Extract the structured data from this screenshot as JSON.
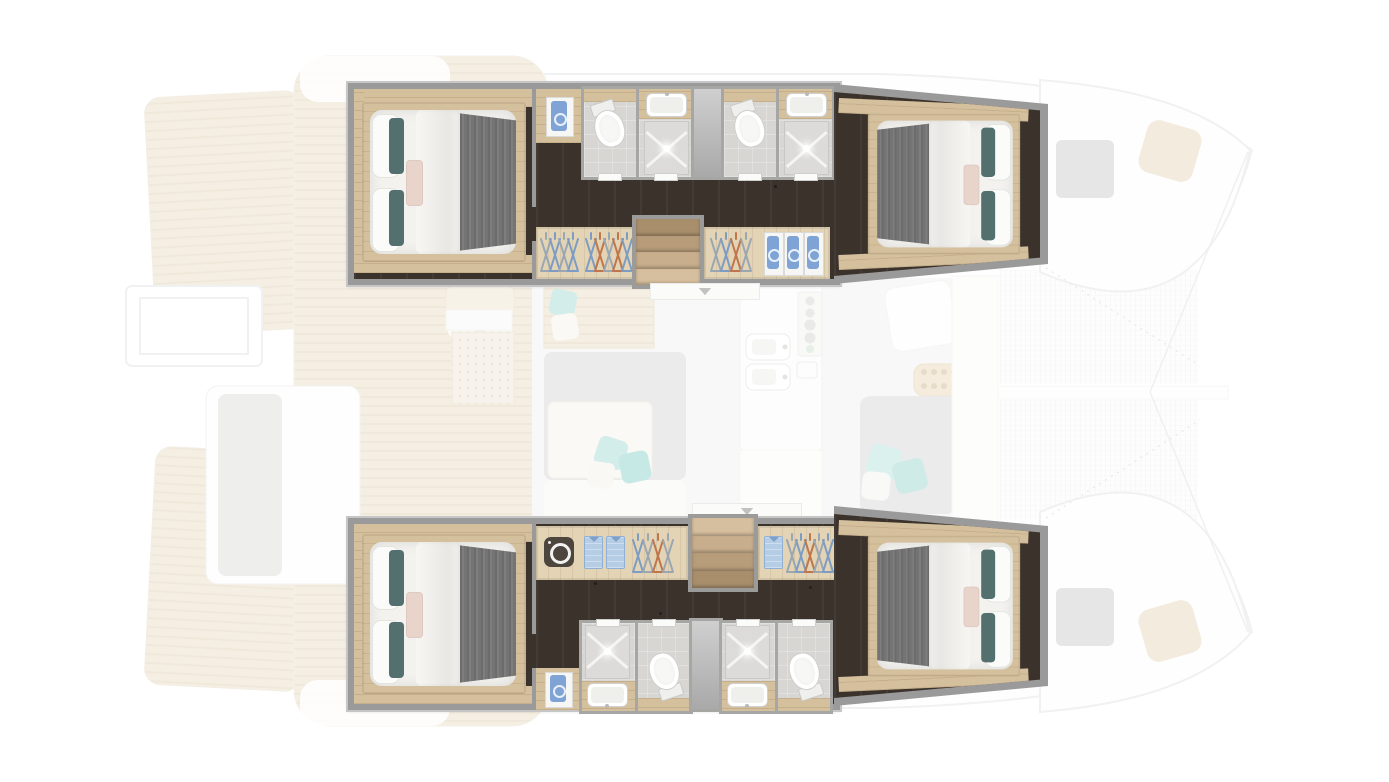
{
  "meta": {
    "description": "Top-down floor plan of a four-cabin catamaran yacht, bow to the right: two highlighted hull interiors each with two double cabins and two bathrooms, a faded central salon with galley, aft cockpit with teak deck and twin swim platforms, and twin bow trampolines."
  },
  "colors": {
    "hull_wall": "#9a9a9a",
    "hull_wall_light": "#c6c6c6",
    "floor_dark": "#3b322c",
    "wood": "#d5c09d",
    "wood_light": "#e3d4b6",
    "bath_floor": "#d8d6d3",
    "bath_wall": "#a6a6a4",
    "fixture": "#f7f7f5",
    "fixture_line": "#cfcfcd",
    "duvet": "#f3f2ef",
    "blanket": "#747474",
    "pillow_teal": "#53706e",
    "pillow_blush": "#e8d4cb",
    "aqua": "#a5dad4",
    "towel": "#7fa3d4",
    "shirt": "#b6cde6",
    "hanger_blue": "#7d9cc4",
    "hanger_gray": "#9aa6b2",
    "hanger_orange": "#c0754a",
    "washer": "#4d463e",
    "teak": "#eadfc7",
    "teak_stripe": "#e0d2b6",
    "salon_gray": "#d7d7d6",
    "outline": "#e0e3e7",
    "hatch": "#cdcdcd",
    "net": "#e7e7ea"
  },
  "boat": {
    "view": "top-down",
    "orientation": {
      "bow": "right",
      "stern": "left"
    },
    "counts": {
      "cabins": 4,
      "bathrooms": 4,
      "toilets": 4,
      "washbasins": 4,
      "showers": 4,
      "trampolines": 2,
      "swim_platforms": 2
    },
    "hulls": [
      {
        "id": "top-hull",
        "rooms": [
          {
            "name": "aft-cabin",
            "furniture": [
              "double-island-bed",
              "white-duvet",
              "gray-throw-blanket",
              "two-teal-lumbar-pillows",
              "blush-pillow",
              "oak-bed-platform"
            ]
          },
          {
            "name": "linen-cabinet",
            "contents": [
              "folded-blue-towel"
            ]
          },
          {
            "name": "aft-bathroom",
            "fixtures": [
              "toilet",
              "washbasin",
              "shower-with-x-tray"
            ]
          },
          {
            "name": "forward-bathroom",
            "fixtures": [
              "toilet",
              "washbasin",
              "shower-with-x-tray"
            ]
          },
          {
            "name": "wardrobe-aft",
            "contents": [
              "clothes-hangers"
            ],
            "hanger_count": 9
          },
          {
            "name": "companionway-stairs",
            "steps": 4
          },
          {
            "name": "wardrobe-forward",
            "contents": [
              "clothes-hangers",
              "three-blue-towels-on-shelf"
            ],
            "hanger_count": 4
          },
          {
            "name": "forward-cabin",
            "furniture": [
              "double-island-bed",
              "white-duvet",
              "gray-throw-blanket",
              "two-teal-lumbar-pillows",
              "striped-blush-pillow"
            ]
          }
        ]
      },
      {
        "id": "bottom-hull",
        "rooms": [
          {
            "name": "aft-cabin",
            "furniture": [
              "double-island-bed",
              "white-duvet",
              "gray-throw-blanket",
              "two-teal-lumbar-pillows",
              "blush-pillow",
              "oak-bed-platform"
            ]
          },
          {
            "name": "wardrobe-aft",
            "contents": [
              "washing-machine",
              "two-folded-blue-shirts",
              "clothes-hangers"
            ],
            "hanger_count": 4
          },
          {
            "name": "companionway-stairs",
            "steps": 4
          },
          {
            "name": "wardrobe-forward",
            "contents": [
              "folded-blue-shirt",
              "clothes-hangers"
            ],
            "hanger_count": 5
          },
          {
            "name": "linen-cabinet",
            "contents": [
              "folded-blue-towel"
            ]
          },
          {
            "name": "aft-bathroom",
            "fixtures": [
              "shower-with-x-tray",
              "washbasin",
              "toilet"
            ]
          },
          {
            "name": "forward-bathroom",
            "fixtures": [
              "shower-with-x-tray",
              "washbasin",
              "toilet"
            ]
          },
          {
            "name": "forward-cabin",
            "furniture": [
              "double-island-bed",
              "white-duvet",
              "gray-throw-blanket",
              "two-teal-lumbar-pillows",
              "striped-blush-pillow"
            ]
          }
        ]
      }
    ],
    "salon_faded": {
      "features": [
        "nav-station-with-perforated-panel",
        "sideboard",
        "l-shaped-settee",
        "cream-dining-table",
        "aqua-throw-pillows",
        "galley-double-sink",
        "burner-stove-panel",
        "counter-vents",
        "forward-seat",
        "cup-holder-tray",
        "sun-lounge"
      ]
    },
    "aft_deck_faded": {
      "features": [
        "teak-cockpit-deck",
        "cockpit-table-with-seats",
        "side-bench-with-gray-pad",
        "twin-teak-swim-platforms",
        "boarding-frame"
      ]
    },
    "bow_faded": {
      "features": [
        "twin-trampoline-nets",
        "central-spine-beam",
        "two-gray-deck-hatches",
        "two-tan-anchor-locker-cushions",
        "bridle-lines",
        "lacing-edges"
      ]
    }
  }
}
